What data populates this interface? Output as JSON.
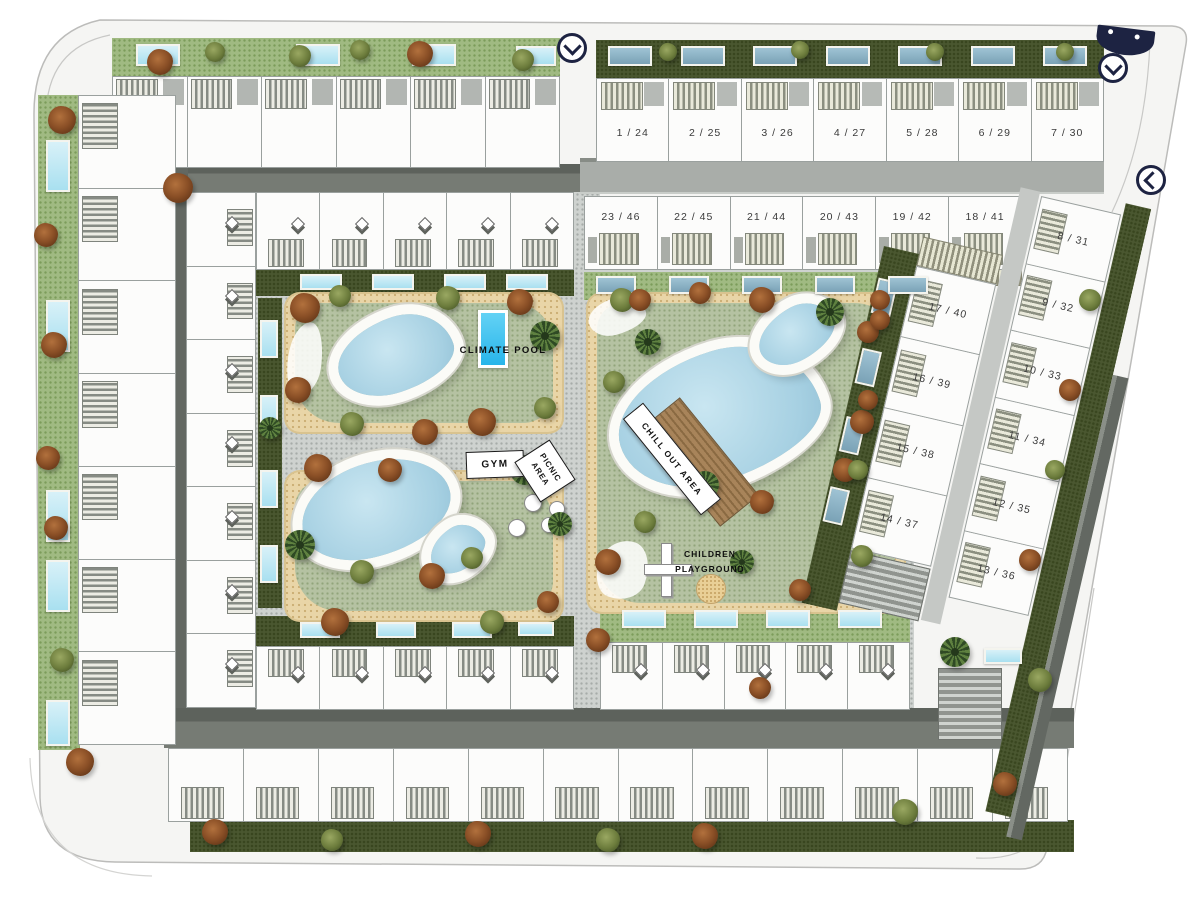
{
  "plan": {
    "type": "residential-site-plan",
    "amenity_labels": {
      "climate_pool": "CLIMATE POOL",
      "gym": "GYM",
      "picnic_area": "PICNIC AREA",
      "chill_out_area": "CHILL OUT AREA",
      "children_playground": "CHILDREN PLAYGROUND"
    },
    "blocks": {
      "north_row": {
        "units": [
          "1 / 24",
          "2 / 25",
          "3 / 26",
          "4 / 27",
          "5 / 28",
          "6 / 29",
          "7 / 30"
        ]
      },
      "second_row": {
        "units": [
          "23 / 46",
          "22 / 45",
          "21 / 44",
          "20 / 43",
          "19 / 42",
          "18 / 41"
        ]
      },
      "east_inner_column": {
        "units": [
          "17 / 40",
          "16 / 39",
          "15 / 38",
          "14 / 37"
        ]
      },
      "east_outer_column": {
        "units": [
          "8 / 31",
          "9 / 32",
          "10 / 33",
          "11 / 34",
          "12 / 35",
          "13 / 36"
        ]
      }
    },
    "markers": {
      "entry_arrows": [
        {
          "id": "north-west-entry",
          "direction": "down"
        },
        {
          "id": "north-east-entry",
          "direction": "down"
        },
        {
          "id": "east-entry",
          "direction": "left"
        }
      ]
    },
    "palette": {
      "navy": "#1d2342",
      "pool_blue": "#aed3e2",
      "climate_pool_blue": "#35c0ef",
      "lawn_green": "#b5c2a2",
      "hedge_green": "#4a5730",
      "sand": "#e9d5a7",
      "road_dark": "#6b706a",
      "cobble": "#ced2cf"
    }
  }
}
